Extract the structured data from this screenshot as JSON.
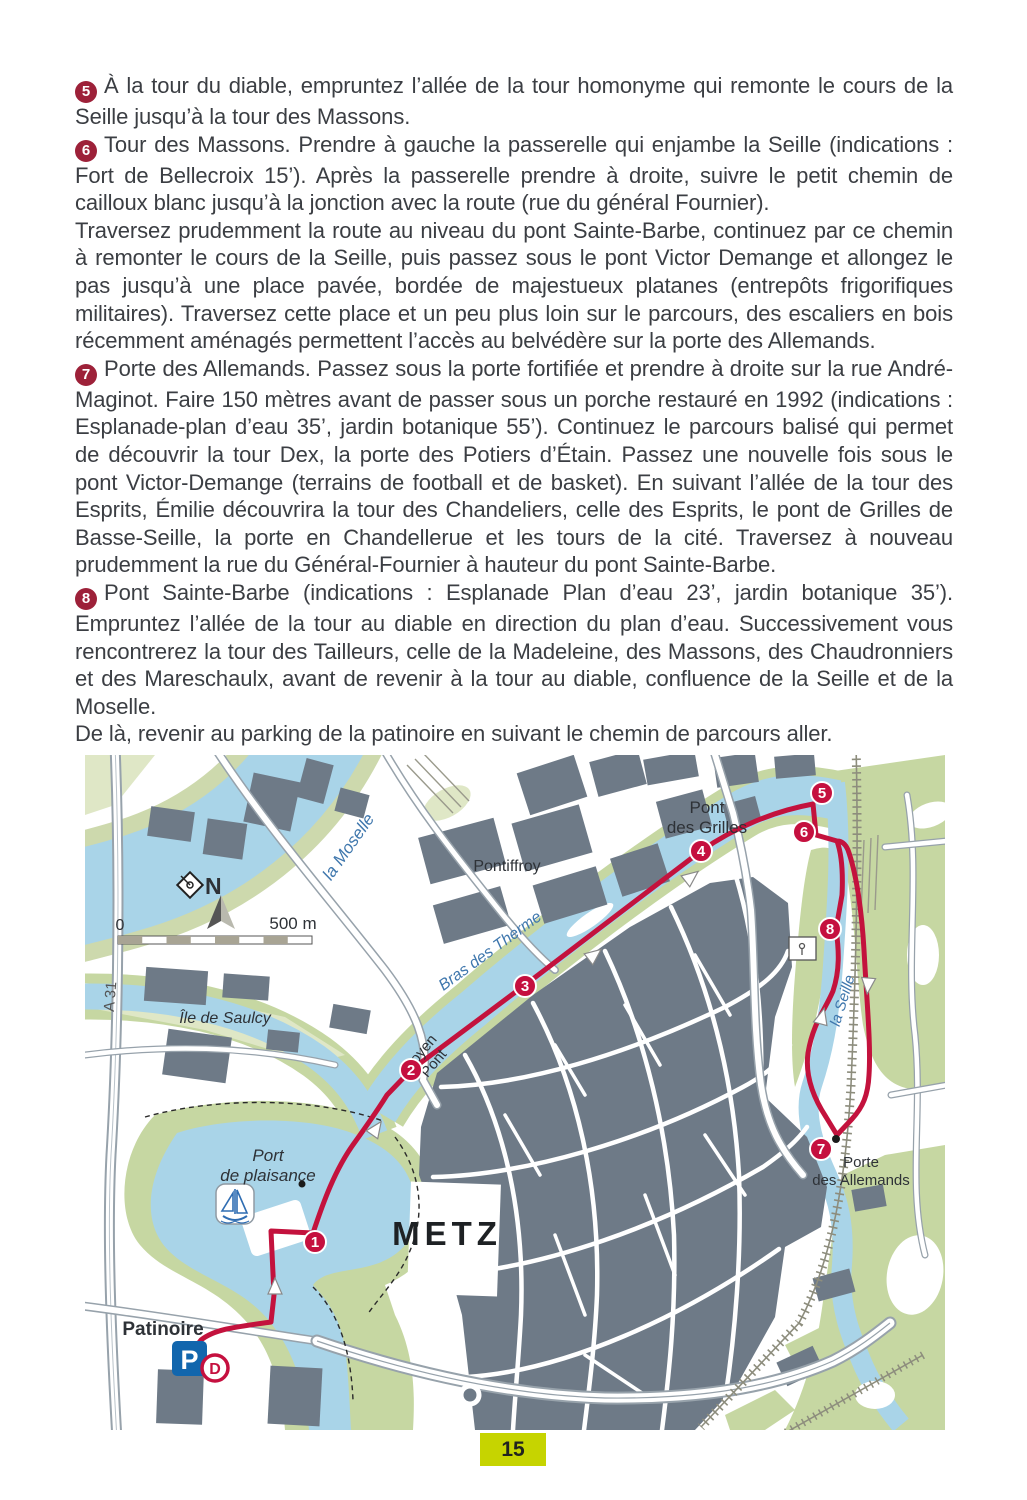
{
  "page": {
    "number": "15",
    "colors": {
      "badge_red": "#9d2139",
      "route_red": "#c3123d",
      "marker_red": "#c5103f",
      "page_number_bg": "#c6d400",
      "water_blue": "#a9d4e8",
      "green_area": "#c6d7a2",
      "building_gray": "#6e7a87",
      "parking_blue": "#1266ad"
    }
  },
  "article": {
    "paragraphs": [
      {
        "badge": "5",
        "text": "À la tour du diable, empruntez l’allée de la tour homonyme qui remonte le cours de la Seille jusqu’à la tour des Massons."
      },
      {
        "badge": "6",
        "text": "Tour des Massons. Prendre à gauche la passerelle qui enjambe la Seille (indications : Fort de Bellecroix 15’). Après la passerelle prendre à droite, suivre le petit chemin de cailloux blanc jusqu’à la jonction avec la route (rue du général Fournier)."
      },
      {
        "badge": "",
        "text": "Traversez prudemment la route au niveau du pont Sainte-Barbe, continuez par ce chemin à remonter le cours de la Seille, puis passez sous le pont Victor Demange et allongez le pas jusqu’à une place pavée, bordée de majestueux platanes (entrepôts frigorifiques militaires). Traversez cette place et un peu plus loin sur le parcours, des escaliers en bois récemment aménagés permettent l’accès au belvédère sur la porte des Allemands."
      },
      {
        "badge": "7",
        "text": "Porte des Allemands. Passez sous la porte fortifiée et prendre à droite sur la rue André-Maginot. Faire 150 mètres avant de passer sous un porche restauré en 1992 (indications : Esplanade-plan d’eau 35’, jardin botanique 55’). Continuez le parcours balisé qui permet de découvrir la tour Dex, la porte des Potiers d’Étain. Passez une nouvelle fois sous le pont Victor-Demange (terrains de football et de basket). En suivant l’allée de la tour des Esprits, Émilie découvrira la tour des Chandeliers, celle des Esprits, le pont de Grilles de Basse-Seille, la porte en Chandellerue et les tours de la cité. Traversez à nouveau prudemment la rue du Général-Fournier à hauteur du pont Sainte-Barbe."
      },
      {
        "badge": "8",
        "text": "Pont Sainte-Barbe (indications : Esplanade Plan d’eau 23’, jardin botanique 35’). Empruntez l’allée de la tour au diable en direction du plan d’eau. Successivement vous rencontrerez la tour des Tailleurs, celle de la Madeleine, des Massons, des Chaudronniers et des Mareschaulx, avant de revenir à la tour au diable, confluence de la Seille et de la Moselle."
      },
      {
        "badge": "",
        "text": "De là, revenir au parking de la patinoire en suivant le chemin de parcours aller."
      }
    ]
  },
  "map": {
    "labels": {
      "moselle": "la Moselle",
      "bras_des_therme": "Bras des Therme",
      "la_seille": "la Seille",
      "pontiffroy": "Pontiffroy",
      "pont_des_grilles_1": "Pont",
      "pont_des_grilles_2": "des Grilles",
      "ile_de_saulcy": "Île de Saulcy",
      "moyen_pont_1": "Moyen",
      "moyen_pont_2": "Pont",
      "metz": "METZ",
      "port_de_plaisance_1": "Port",
      "port_de_plaisance_2": "de plaisance",
      "patinoire": "Patinoire",
      "porte_des_allemands_1": "Porte",
      "porte_des_allemands_2": "des Allemands",
      "a31": "A 31",
      "north": "N",
      "scale_zero": "0",
      "scale_label": "500 m",
      "parking": "P",
      "depart": "D"
    },
    "markers": [
      {
        "label": "1"
      },
      {
        "label": "2"
      },
      {
        "label": "3"
      },
      {
        "label": "4"
      },
      {
        "label": "5"
      },
      {
        "label": "6"
      },
      {
        "label": "7"
      },
      {
        "label": "8"
      }
    ]
  }
}
